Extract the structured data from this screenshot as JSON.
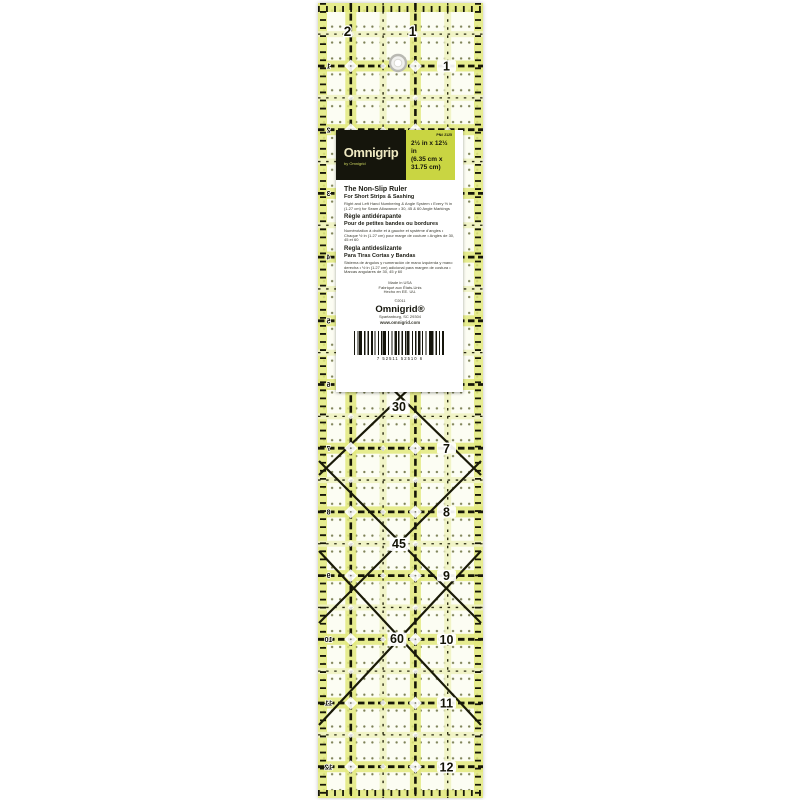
{
  "colors": {
    "line": "#161608",
    "halo": "#e2e97c",
    "halo_light": "#f0f3c2",
    "star_white": "#ffffff",
    "label_green": "#c9d542",
    "label_black": "#15150c",
    "brand_cream": "#efe9c2"
  },
  "ruler": {
    "top_numbers": [
      {
        "text": "2"
      },
      {
        "text": "1"
      }
    ],
    "right_numbers": [
      {
        "inch": 1,
        "text": "1"
      },
      {
        "inch": 7,
        "text": "7"
      },
      {
        "inch": 8,
        "text": "8"
      },
      {
        "inch": 9,
        "text": "9"
      },
      {
        "inch": 10,
        "text": "10"
      },
      {
        "inch": 11,
        "text": "11"
      },
      {
        "inch": 12,
        "text": "12"
      }
    ],
    "left_numbers": [
      {
        "inch": 1,
        "text": "1"
      },
      {
        "inch": 2,
        "text": "2"
      },
      {
        "inch": 3,
        "text": "3"
      },
      {
        "inch": 4,
        "text": "4"
      },
      {
        "inch": 5,
        "text": "5"
      },
      {
        "inch": 6,
        "text": "6"
      },
      {
        "inch": 7,
        "text": "7"
      },
      {
        "inch": 8,
        "text": "8"
      },
      {
        "inch": 9,
        "text": "9"
      },
      {
        "inch": 10,
        "text": "10"
      },
      {
        "inch": 11,
        "text": "11"
      },
      {
        "inch": 12,
        "text": "12"
      }
    ],
    "angle_numbers": [
      {
        "text": "30"
      },
      {
        "text": "45"
      },
      {
        "text": "60"
      }
    ]
  },
  "label": {
    "brand": "Omnigrip",
    "brand_sub": "by Omnigrid",
    "part_number": "PN# 2125",
    "size_line1": "2½ in x 12½ in",
    "size_line2": "(6.35 cm x",
    "size_line3": "31.75 cm)",
    "title": "The Non-Slip Ruler",
    "subtitle": "For Short Strips & Sashing",
    "desc_en": "Right and Left Hand Numbering & Angle System • Every ½ in (1.27 cm) for Seam Allowance • 30, 45 & 60 Angle Markings",
    "fr_title": "Règle antidérapante",
    "fr_subtitle": "Pour de petites bandes ou bordures",
    "fr_desc": "Numérotation à droite et à gauche et système d'angles • Chaque ½ in (1.27 cm) pour marge de couture • Angles de 30, 45 et 60",
    "es_title": "Regla antideslizante",
    "es_subtitle": "Para Tiras Cortas y Bandas",
    "es_desc": "Sistema de ángulos y numeración de mano izquierda y mano derecha • ½ in (1.27 cm) adicional para margen de costura • Marcas angulares de 30, 45 y 60",
    "made_line1": "Made in USA",
    "made_line2": "Fabriqué aux États-Unis",
    "made_line3": "Hecho en EE. UU.",
    "copyright": "©2011",
    "company": "Omnigrid®",
    "address": "Spartanburg, SC 29304",
    "website": "www.omnigrid.com",
    "barcode_digits": "7 52511 52510 6"
  }
}
